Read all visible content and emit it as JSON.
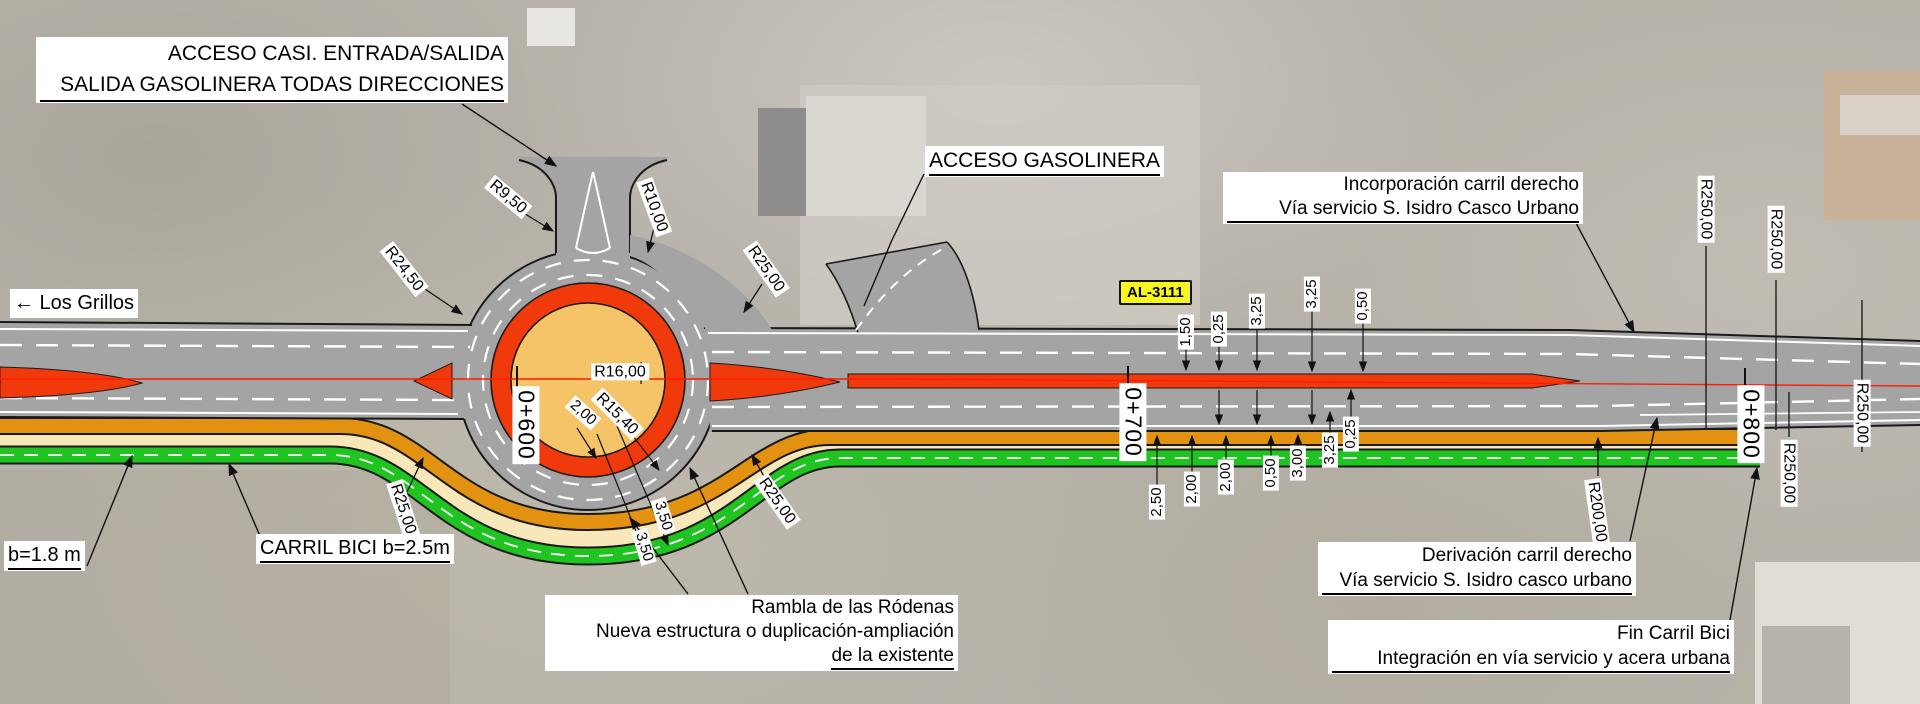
{
  "callouts": {
    "acceso_casi": {
      "line1": "ACCESO CASI. ENTRADA/SALIDA",
      "line2": "SALIDA GASOLINERA TODAS DIRECCIONES"
    },
    "acceso_gasolinera": {
      "line1": "ACCESO GASOLINERA"
    },
    "los_grillos": {
      "line1": "← Los Grillos"
    },
    "al_3111": {
      "line1": "AL-3111"
    },
    "incorporacion": {
      "line1": "Incorporación carril derecho",
      "line2": "Vía servicio S. Isidro Casco Urbano"
    },
    "derivacion": {
      "line1": "Derivación carril derecho",
      "line2": "Vía servicio S. Isidro casco urbano"
    },
    "fin_carril_bici": {
      "line1": "Fin Carril Bici",
      "line2": "Integración en vía servicio y acera urbana"
    },
    "rambla": {
      "line1": "Rambla de las Ródenas",
      "line2": "Nueva estructura o duplicación-ampliación",
      "line3": "de la existente"
    },
    "b_arcen": {
      "line1": "b=1.8 m"
    },
    "carril_bici": {
      "line1": "CARRIL BICI b=2.5m"
    }
  },
  "stations": [
    {
      "label": "0+600"
    },
    {
      "label": "0+700"
    },
    {
      "label": "0+800"
    }
  ],
  "radius_labels": [
    {
      "label": "R9,50"
    },
    {
      "label": "R24,50"
    },
    {
      "label": "R10,00"
    },
    {
      "label": "R25,00"
    },
    {
      "label": "R16,00"
    },
    {
      "label": "R15,40"
    },
    {
      "label": "R25,00"
    },
    {
      "label": "R25,00"
    },
    {
      "label": "R250,00"
    },
    {
      "label": "R250,00"
    },
    {
      "label": "R200,00"
    },
    {
      "label": "R250,00"
    },
    {
      "label": "R250,00"
    }
  ],
  "dimensions": {
    "roundabout": [
      "2,00",
      "3,50",
      "3,50"
    ],
    "top_row": [
      "1,50",
      "0,25",
      "3,25",
      "3,25",
      "0,50"
    ],
    "bottom_row": [
      "2,50",
      "2,00",
      "2,00",
      "0,50",
      "3,00",
      "3,25",
      "0,25"
    ]
  },
  "colors": {
    "asphalt": "#a4a4a4",
    "median_red": "#f13a0c",
    "axis_red": "#ff1a00",
    "island_fill": "#f5c468",
    "bike_lane_green": "#1fc420",
    "service_band_orange": "#e39110",
    "verge_cream": "#f7e7b9",
    "sign_yellow": "#f7f71e"
  }
}
